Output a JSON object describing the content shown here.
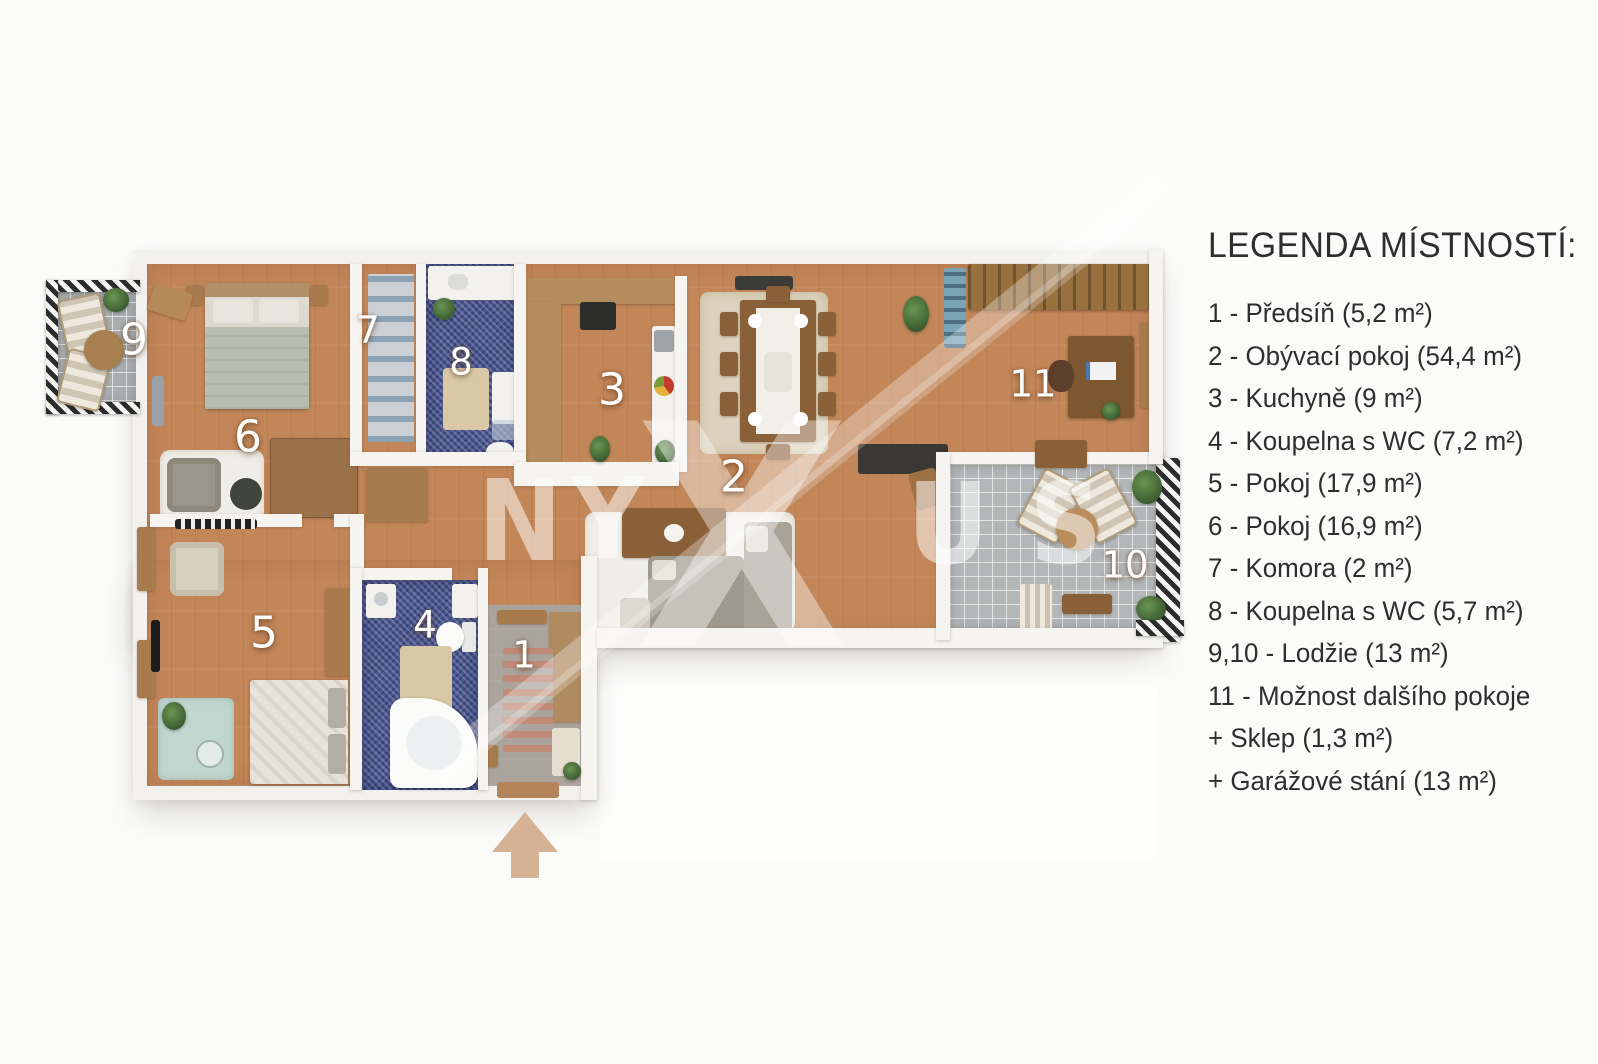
{
  "legend": {
    "title": "LEGENDA MÍSTNOSTÍ:",
    "items": [
      "1 - Předsíň (5,2 m²)",
      "2 - Obývací pokoj (54,4 m²)",
      "3 - Kuchyně (9 m²)",
      "4 - Koupelna s WC (7,2 m²)",
      "5 - Pokoj (17,9 m²)",
      "6 - Pokoj (16,9 m²)",
      "7 - Komora (2 m²)",
      "8 - Koupelna s WC (5,7 m²)",
      "9,10 - Lodžie (13 m²)",
      "11 - Možnost dalšího pokoje",
      "+ Sklep (1,3 m²)",
      "+ Garážové stání (13 m²)"
    ]
  },
  "plan": {
    "room_labels": [
      "1",
      "2",
      "3",
      "4",
      "5",
      "6",
      "7",
      "8",
      "9",
      "10",
      "11"
    ]
  },
  "watermark": {
    "letters": [
      "N",
      "Y",
      "X",
      "U",
      "S"
    ]
  },
  "colors": {
    "wood_floor": "#c28659",
    "bathroom_tile": "#4a5690",
    "balcony_tile": "#a9adae",
    "wall": "#f5f4f0",
    "entrance_arrow": "#d6b294",
    "legend_text": "#2e2e2e"
  }
}
